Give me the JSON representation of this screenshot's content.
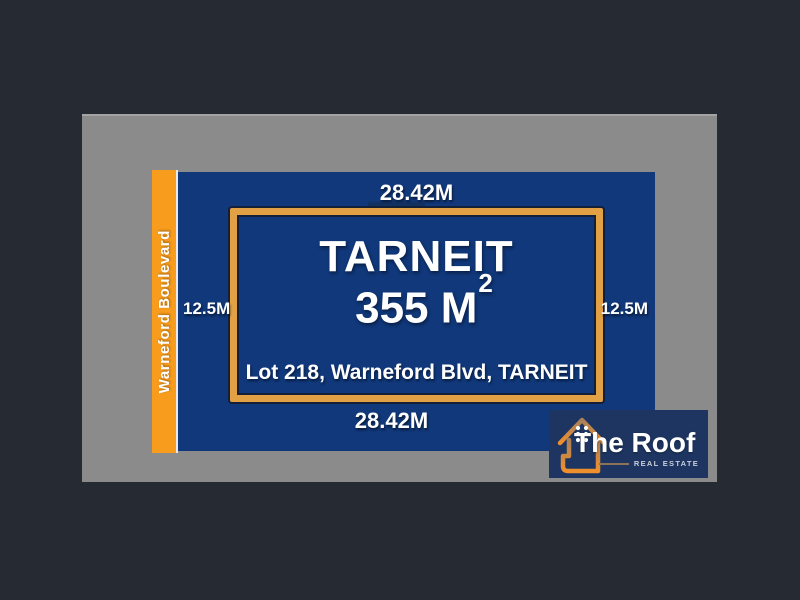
{
  "colors": {
    "canvas_background": "#262b33",
    "land_gray": "#8b8b8b",
    "lot_blue": "#10387a",
    "road_orange": "#f89c1e",
    "frame_orange": "#e1a144",
    "frame_outline_navy": "#141f38",
    "logo_background": "#1d3560",
    "logo_house_gradient_top": "#a8805a",
    "logo_house_gradient_bottom": "#ef8f2d",
    "text_white": "#ffffff"
  },
  "road": {
    "name": "Warneford Boulevard"
  },
  "dimensions": {
    "top": "28.42M",
    "bottom": "28.42M",
    "left": "12.5M",
    "right": "12.5M"
  },
  "lot": {
    "suburb": "TARNEIT",
    "area_value": "355 M",
    "area_superscript": "2",
    "address": "Lot 218, Warneford Blvd, TARNEIT"
  },
  "logo": {
    "brand": "The Roof",
    "tagline": "REAL ESTATE",
    "icon": "house-outline-icon"
  }
}
